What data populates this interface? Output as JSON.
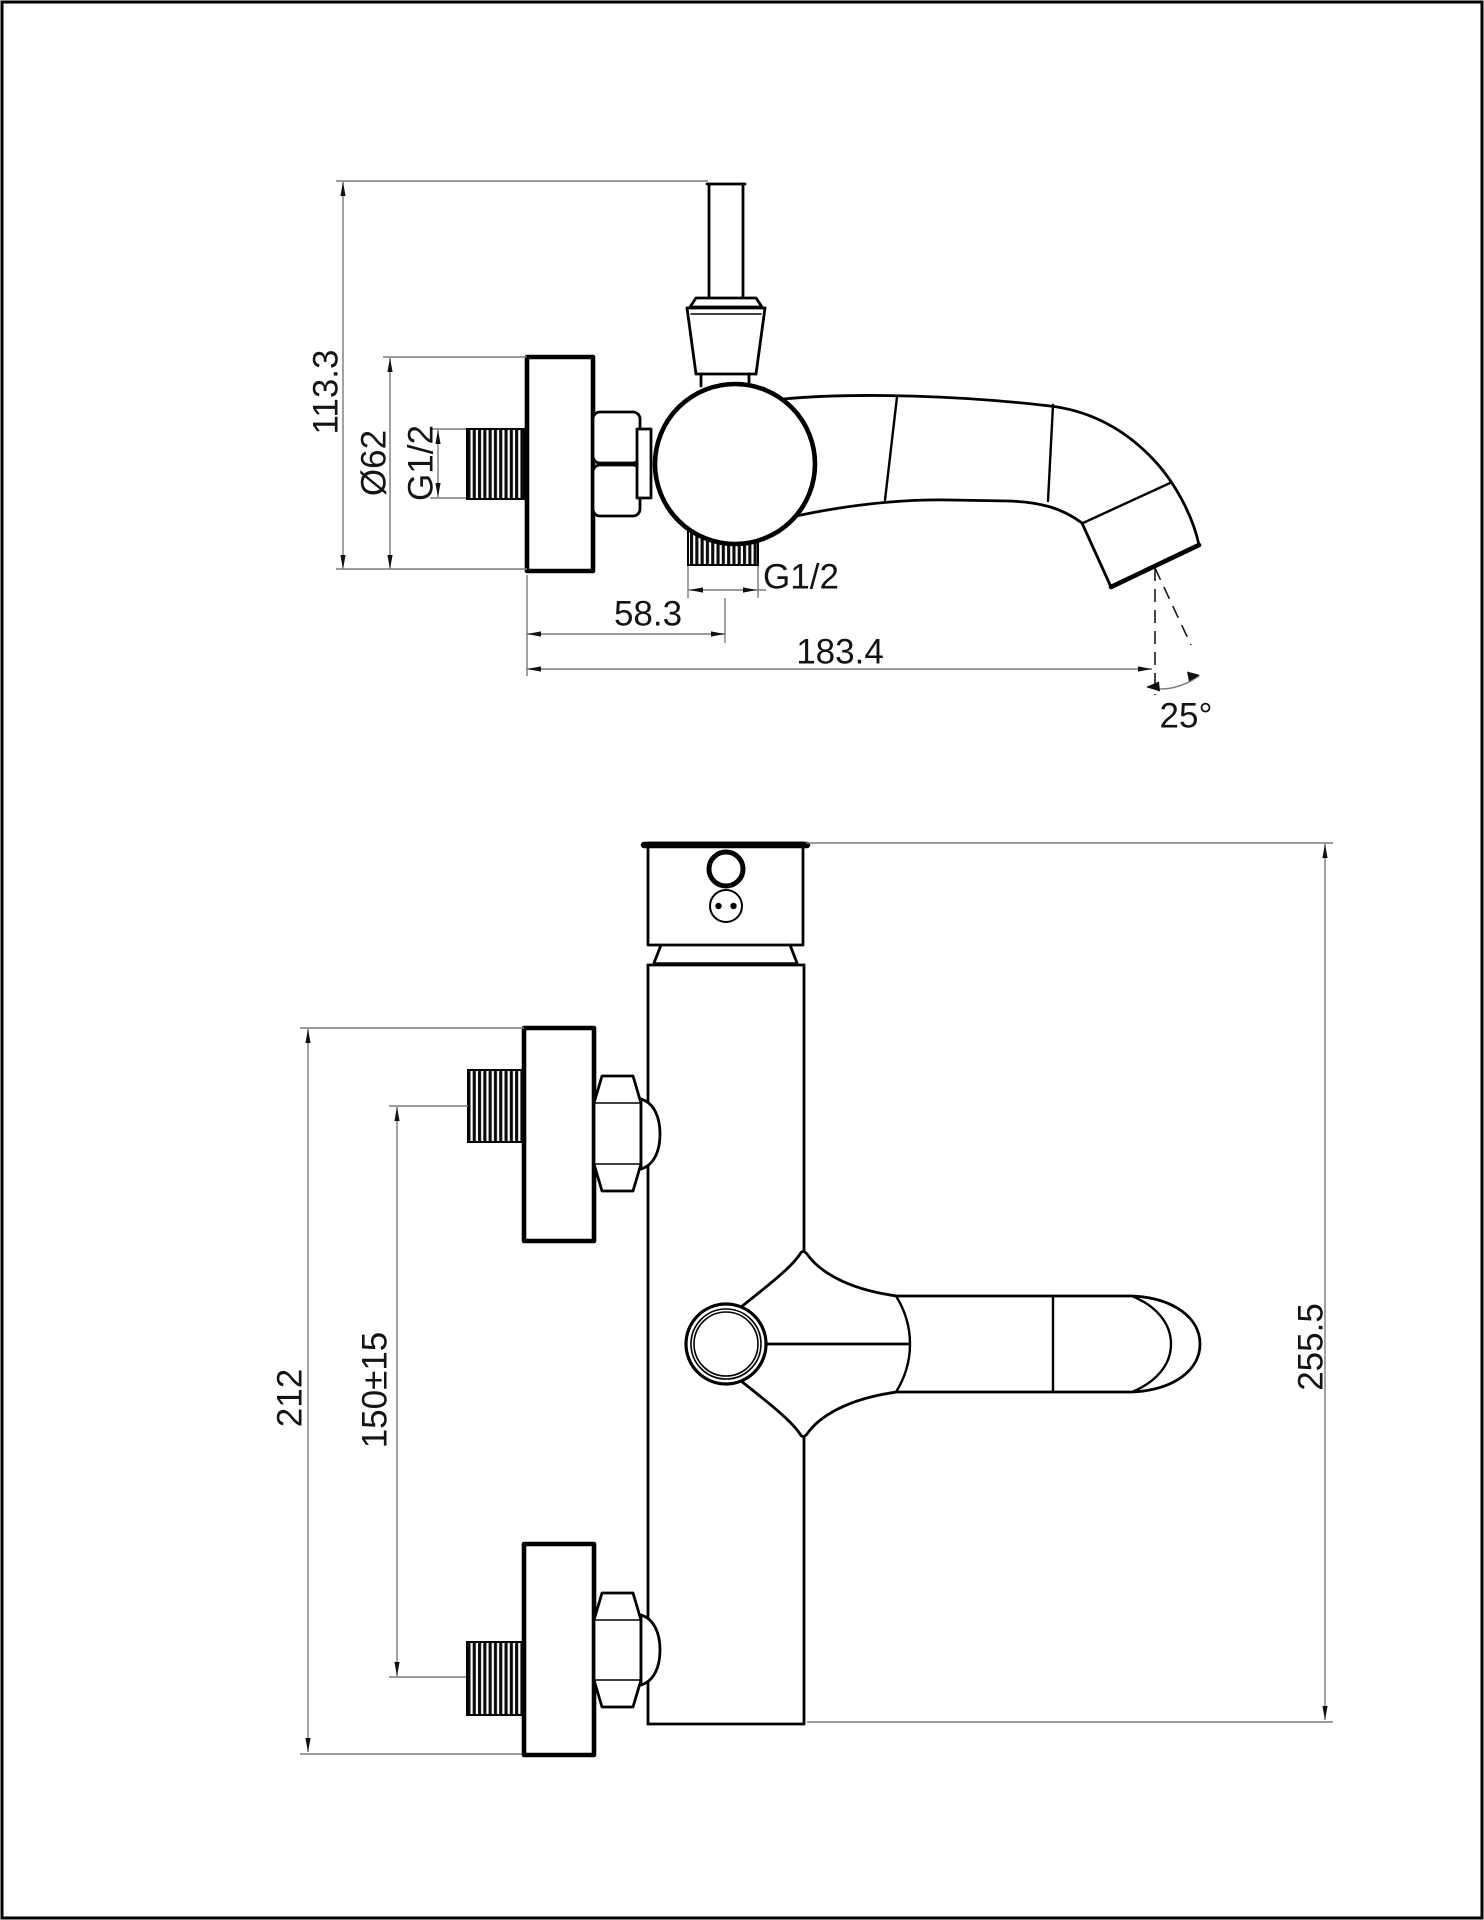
{
  "drawing": {
    "type": "technical-cad-drawing",
    "background": "#ffffff",
    "geometry_color": "#000000",
    "dimension_line_color": "#7a7a7a",
    "views": {
      "side": {
        "label": "side-view-of-wall-mounted-bath-mixer",
        "dims": {
          "overall_height": "113.3",
          "flange_diameter": "Ø62",
          "inlet_thread": "G1/2",
          "outlet_thread": "G1/2",
          "wall_to_outlet": "58.3",
          "wall_to_spout_tip": "183.4",
          "spout_angle": "25°"
        }
      },
      "front": {
        "label": "front-view-of-wall-mounted-bath-mixer",
        "dims": {
          "flange_outer_span": "212",
          "inlet_center_distance": "150±15",
          "overall_height": "255.5"
        }
      }
    }
  }
}
